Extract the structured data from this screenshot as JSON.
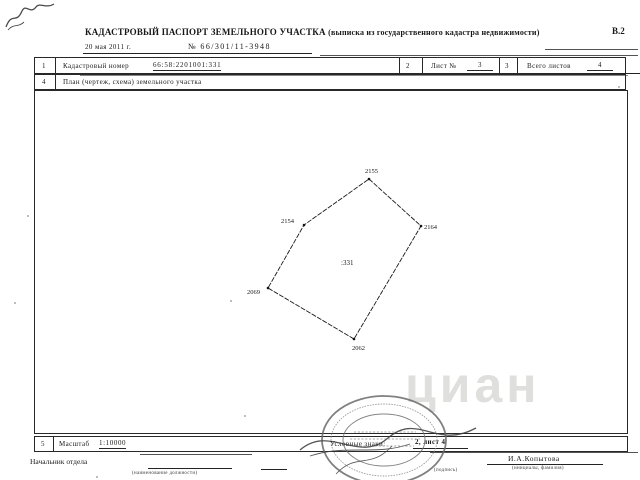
{
  "header": {
    "title": "КАДАСТРОВЫЙ ПАСПОРТ ЗЕМЕЛЬНОГО УЧАСТКА",
    "subtitle": "(выписка из государственного кадастра недвижимости)",
    "form_code": "В.2",
    "date": "20 мая 2011 г.",
    "doc_number": "№  66/301/11-3948"
  },
  "table": {
    "row1": {
      "cell": "1",
      "label": "Кадастровый номер",
      "value": "66:58:2201001:331"
    },
    "sheet": {
      "cell": "2",
      "label": "Лист №",
      "value": "3"
    },
    "total": {
      "cell": "3",
      "label": "Всего листов",
      "value": "4"
    },
    "plan_row": {
      "cell": "4",
      "label": "План (чертеж, схема) земельного участка"
    },
    "scale_row": {
      "cell": "5",
      "label": "Масштаб",
      "value": "1:10000"
    }
  },
  "plan": {
    "parcel_label": ":331",
    "vertex_labels": [
      "2155",
      "2154",
      "2164",
      "2069",
      "2062"
    ]
  },
  "footer": {
    "legend_label": "Условные знаки:",
    "legend_value": "2, лист 4",
    "official_position": "Начальник отдела",
    "position_hint": "(наименование должности)",
    "signature_hint": "(подпись)",
    "official_name": "И.А.Копытова",
    "name_hint": "(инициалы, фамилия)"
  },
  "watermark": "циан"
}
